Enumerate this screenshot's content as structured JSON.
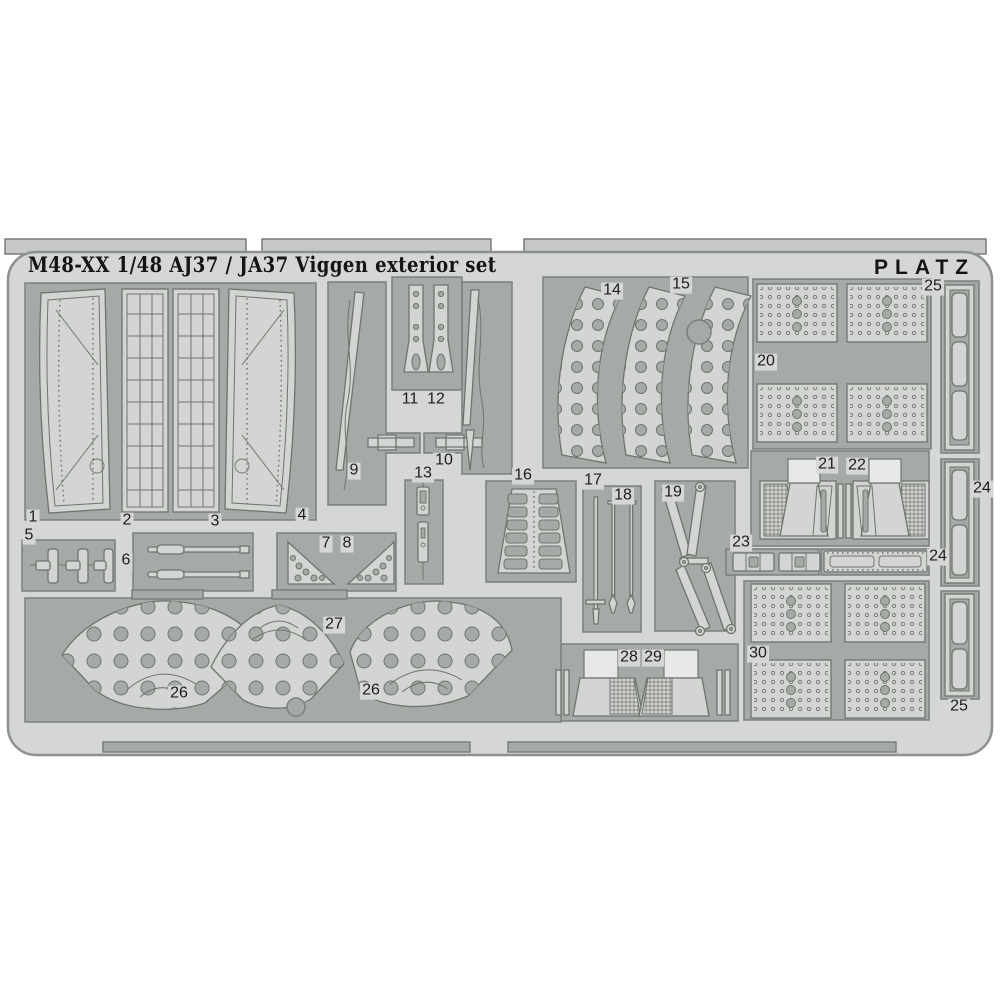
{
  "header": {
    "title": "M48-XX 1/48 AJ37 / JA37 Viggen exterior set",
    "brand": "PLATZ"
  },
  "colors": {
    "page_bg": "#ffffff",
    "sheet": "#d5d7d4",
    "part": "#d2d5d1",
    "recess": "#a6aaa6",
    "outline": "#70746f",
    "edge": "#8d918d",
    "text": "#141414"
  },
  "sheet": {
    "kind": "photo-etched parts fret",
    "part_numbers_visible": [
      "1",
      "2",
      "3",
      "4",
      "5",
      "6",
      "7",
      "8",
      "9",
      "10",
      "11",
      "12",
      "13",
      "14",
      "15",
      "16",
      "17",
      "18",
      "19",
      "20",
      "21",
      "22",
      "23",
      "24",
      "25",
      "26",
      "27",
      "28",
      "29",
      "30"
    ]
  },
  "labels": [
    {
      "text": "1"
    },
    {
      "text": "2"
    },
    {
      "text": "3"
    },
    {
      "text": "4"
    },
    {
      "text": "5"
    },
    {
      "text": "6"
    },
    {
      "text": "7"
    },
    {
      "text": "8"
    },
    {
      "text": "9"
    },
    {
      "text": "10"
    },
    {
      "text": "11"
    },
    {
      "text": "12"
    },
    {
      "text": "13"
    },
    {
      "text": "14"
    },
    {
      "text": "15"
    },
    {
      "text": "16"
    },
    {
      "text": "17"
    },
    {
      "text": "18"
    },
    {
      "text": "19"
    },
    {
      "text": "20"
    },
    {
      "text": "21"
    },
    {
      "text": "22"
    },
    {
      "text": "23"
    },
    {
      "text": "24"
    },
    {
      "text": "24"
    },
    {
      "text": "25"
    },
    {
      "text": "25"
    },
    {
      "text": "26"
    },
    {
      "text": "26"
    },
    {
      "text": "27"
    },
    {
      "text": "28"
    },
    {
      "text": "29"
    },
    {
      "text": "30"
    }
  ]
}
